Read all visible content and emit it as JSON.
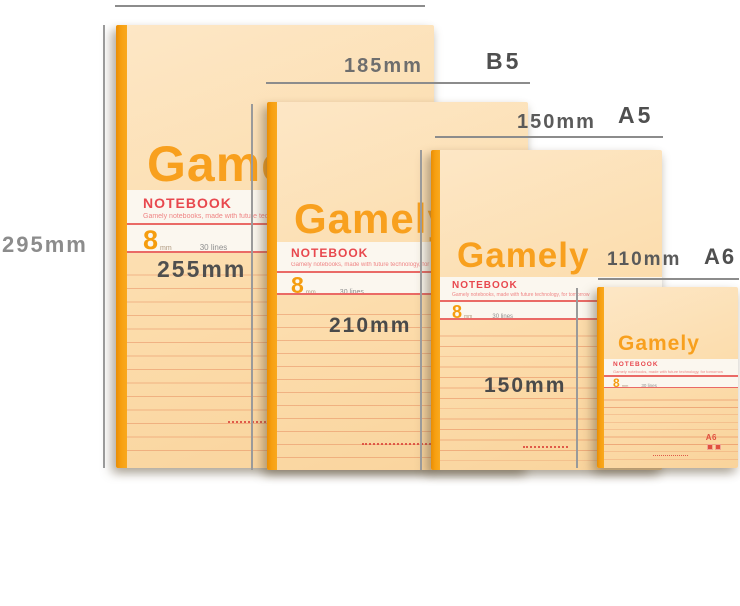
{
  "cover": {
    "brand": "Gamely",
    "label": "NOTEBOOK",
    "tagline": "Gamely notebooks, made with future technology, for tomorrow",
    "ruling_value": "8",
    "ruling_unit": "mm",
    "ruling_lines": "30 lines",
    "a6_corner_mark": "A6"
  },
  "measurements": {
    "a4_height": "295mm",
    "b5_height": "255mm",
    "b5_width": "185mm",
    "b5_name": "B5",
    "a5_width": "150mm",
    "a5_name": "A5",
    "a5_height": "210mm",
    "a6_width": "110mm",
    "a6_name": "A6",
    "a6_height": "150mm"
  },
  "colors": {
    "cover_tan": "#fcdcab",
    "spine_orange": "#f79f10",
    "brand_orange": "#f8a01e",
    "label_red": "#e8484e",
    "rule_red": "#ea6a66",
    "measure_line_gray": "#8c8c8c",
    "measure_text_gray": "#4f4f4f"
  }
}
